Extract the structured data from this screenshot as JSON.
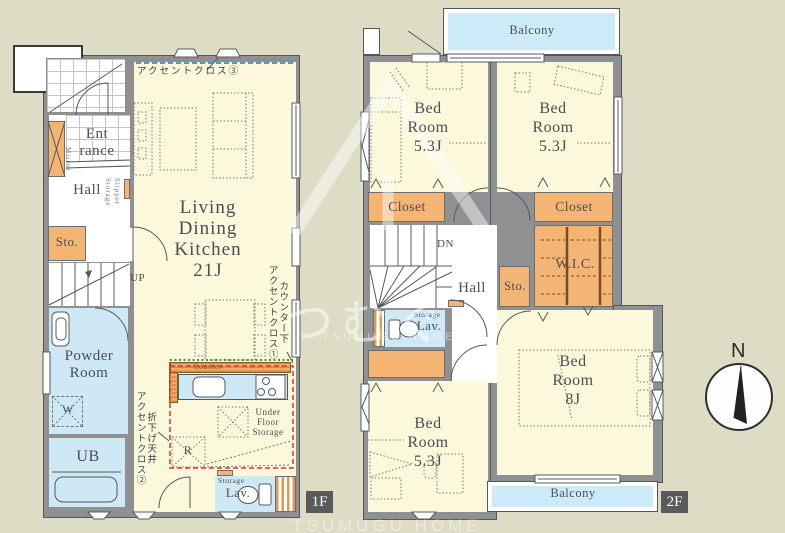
{
  "colors": {
    "bg": "#dedcc5",
    "floor": "#fbf8dc",
    "wall": "#8e9092",
    "blue": "#cfe8f5",
    "orange": "#f3b474",
    "balcony": "#cdeaf8",
    "tag": "#595a5c"
  },
  "watermark": {
    "jp": "つむぐ",
    "en": "TSUMUGU HOME",
    "en2": "TSUMUGU HOME"
  },
  "compass": {
    "north": "N"
  },
  "floor1": {
    "tag": "1F",
    "accent_cloth_3": "アクセントクロス③",
    "accent_cloth_1a": "カウンター下",
    "accent_cloth_1b": "アクセントクロス①",
    "accent_cloth_2a": "折下げ天井",
    "accent_cloth_2b": "アクセントクロス②",
    "entrance_l1": "Ent",
    "entrance_l2": "rance",
    "mirror": "Mirror",
    "hall": "Hall",
    "slipper_storage": "Slipper Storage",
    "sto": "Sto.",
    "up": "UP",
    "powder_l1": "Powder",
    "powder_l2": "Room",
    "washer": "W",
    "ub": "UB",
    "ldk_l1": "Living",
    "ldk_l2": "Dining",
    "ldk_l3": "Kitchen",
    "ldk_l4": "21J",
    "counter": "Counter",
    "ufs_l1": "Under",
    "ufs_l2": "Floor",
    "ufs_l3": "Storage",
    "fridge": "R",
    "storage": "Storage",
    "lav": "Lav."
  },
  "floor2": {
    "tag": "2F",
    "balcony_top": "Balcony",
    "balcony_bottom": "Balcony",
    "bedroom_nw": {
      "l1": "Bed",
      "l2": "Room",
      "l3": "5.3J"
    },
    "bedroom_ne": {
      "l1": "Bed",
      "l2": "Room",
      "l3": "5.3J"
    },
    "bedroom_sw": {
      "l1": "Bed",
      "l2": "Room",
      "l3": "5.3J"
    },
    "bedroom_se": {
      "l1": "Bed",
      "l2": "Room",
      "l3": "8J"
    },
    "closet_nw": "Closet",
    "closet_ne": "Closet",
    "closet_sw": "Closet",
    "wic": "W.I.C.",
    "dn": "DN",
    "hall": "Hall",
    "sto": "Sto.",
    "storage": "Storage",
    "lav": "Lav."
  }
}
